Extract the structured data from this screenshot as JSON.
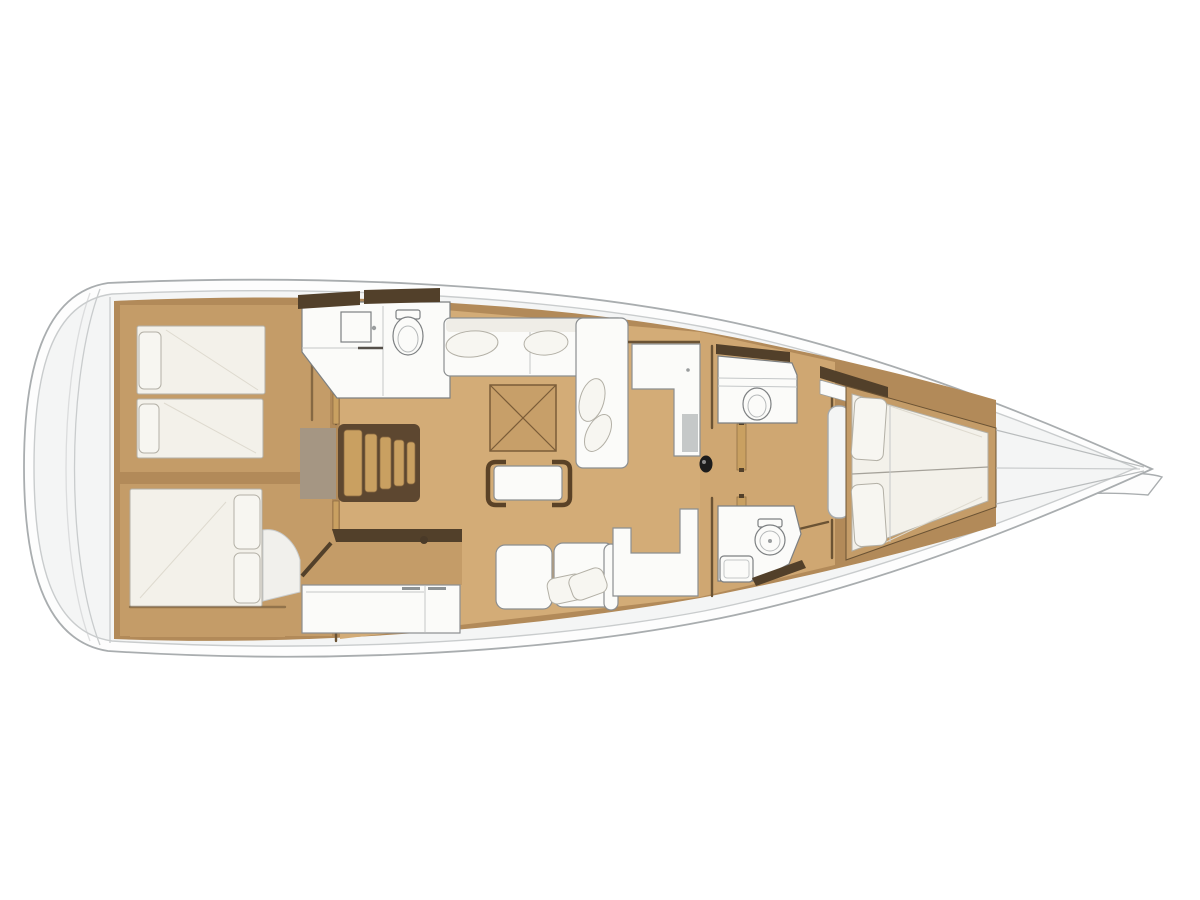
{
  "diagram": {
    "type": "yacht-interior-floor-plan",
    "view": "top-down",
    "orientation": "bow-right",
    "rooms": [
      {
        "id": "aft-cabin-port",
        "name": "aft cabin port with twin berths"
      },
      {
        "id": "aft-cabin-starboard",
        "name": "aft cabin starboard with double berth"
      },
      {
        "id": "companionway-stairs",
        "name": "companionway stairs"
      },
      {
        "id": "aft-head-port",
        "name": "aft head with shower and toilet"
      },
      {
        "id": "salon",
        "name": "salon with L-sofa, folding table and coffee bench"
      },
      {
        "id": "galley",
        "name": "galley with counter and cabinets"
      },
      {
        "id": "sofa-starboard",
        "name": "starboard salon sofa with pillows"
      },
      {
        "id": "nav-seat",
        "name": "navigation seat"
      },
      {
        "id": "mid-head-starboard",
        "name": "mid head with toilet and sink"
      },
      {
        "id": "forward-head",
        "name": "forward head with toilet"
      },
      {
        "id": "forward-cabin",
        "name": "forward cabin with tapered V-berth"
      },
      {
        "id": "bow",
        "name": "bow with anchor fitting"
      }
    ]
  },
  "colors": {
    "bg": "#ffffff",
    "hull-fill": "#fdfdfd",
    "hull-stroke": "#a9adaf",
    "deck-fill": "#f4f5f5",
    "deck-line": "#c9cccd",
    "wood-base": "#b28a59",
    "wood-floor": "#d3ac77",
    "wood-mid": "#c49c68",
    "wood-step": "#c9a061",
    "dark-trim": "#52402a",
    "wall-line": "#6b5334",
    "furn-white": "#fbfbf9",
    "furn-stroke": "#8b8e90",
    "mattress": "#f3f1ea",
    "mattress-stroke": "#b3b0a6",
    "pillow": "#f7f6f1",
    "appliance": "#c5c8c8",
    "mast": "#1c1c1c"
  }
}
